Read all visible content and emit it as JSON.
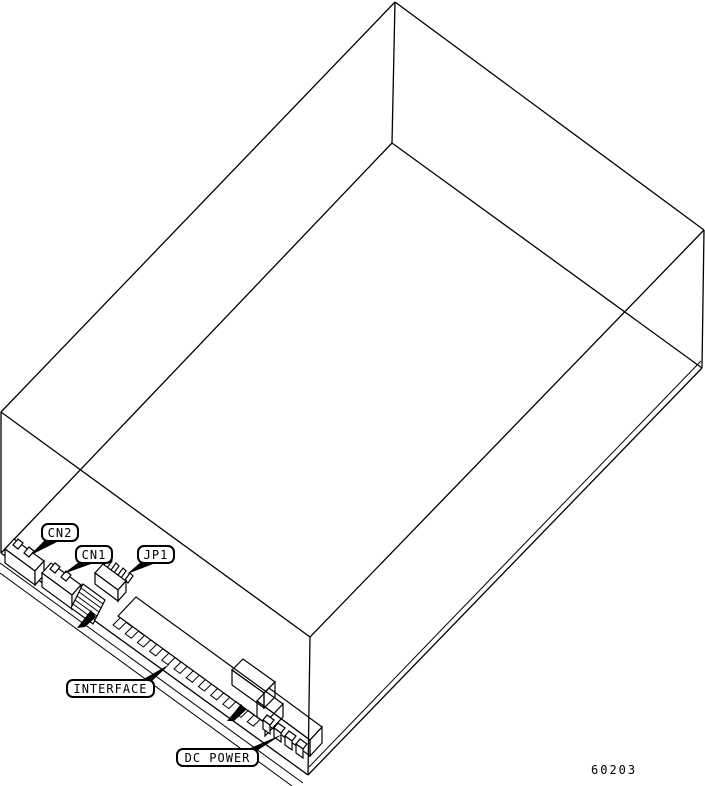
{
  "figure": {
    "description": "Isometric line drawing of a disk drive enclosure showing rear PCB-edge connectors",
    "drawing_number": "60203",
    "callouts": {
      "cn2": "CN2",
      "cn1": "CN1",
      "jp1": "JP1",
      "interface": "INTERFACE",
      "dc_power": "DC POWER"
    },
    "colors": {
      "line": "#000000",
      "background": "#ffffff"
    }
  }
}
